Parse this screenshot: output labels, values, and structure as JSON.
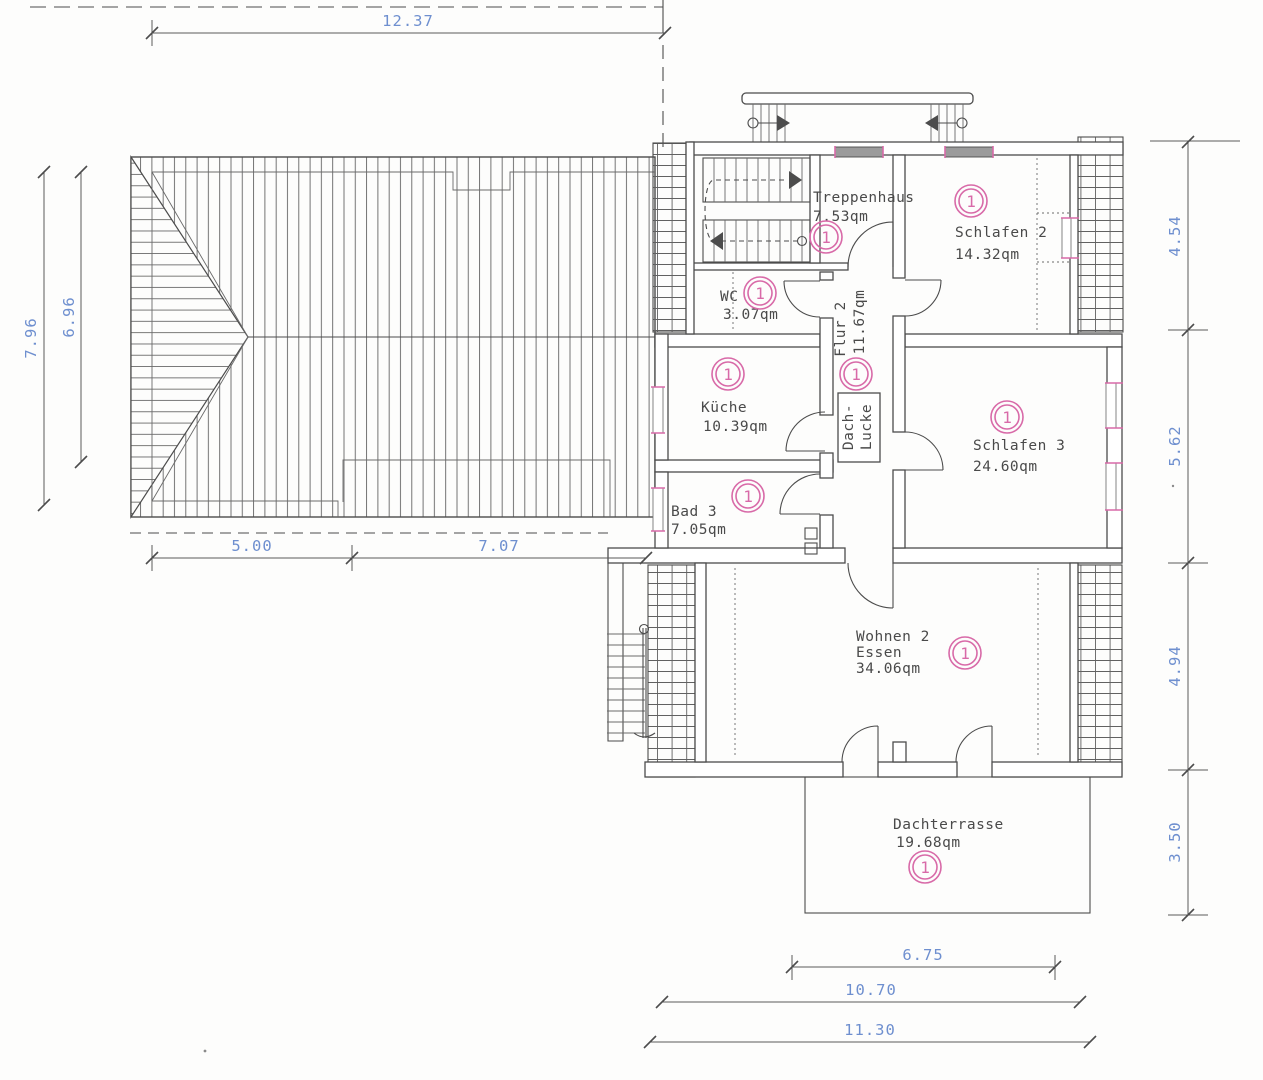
{
  "plan": {
    "rooms": [
      {
        "id": "treppenhaus",
        "name": "Treppenhaus",
        "area": "7.53qm"
      },
      {
        "id": "schlafen2",
        "name": "Schlafen 2",
        "area": "14.32qm"
      },
      {
        "id": "wc",
        "name": "WC",
        "area": "3.07qm"
      },
      {
        "id": "kueche",
        "name": "Küche",
        "area": "10.39qm"
      },
      {
        "id": "flur2",
        "name": "Flur 2",
        "area": "11.67qm"
      },
      {
        "id": "schlafen3",
        "name": "Schlafen 3",
        "area": "24.60qm"
      },
      {
        "id": "bad3",
        "name": "Bad 3",
        "area": "7.05qm"
      },
      {
        "id": "wohnen2",
        "name": "Wohnen 2",
        "name2": "Essen",
        "area": "34.06qm"
      },
      {
        "id": "dachterrasse",
        "name": "Dachterrasse",
        "area": "19.68qm"
      }
    ],
    "roof_hatch_label": {
      "line1": "Dach-",
      "line2": "Lucke"
    },
    "marker": "1",
    "dimensions": {
      "top": "12.37",
      "left_outer": "7.96",
      "left_inner": "6.96",
      "lower_left": [
        "5.00",
        "7.07"
      ],
      "right": [
        "4.54",
        "5.62",
        "4.94",
        "3.50"
      ],
      "bottom": [
        "6.75",
        "10.70",
        "11.30"
      ]
    },
    "colors": {
      "dimension_text": "#6e8fcf",
      "marker_pink": "#d86aa8",
      "line": "#4c4c4c"
    }
  }
}
